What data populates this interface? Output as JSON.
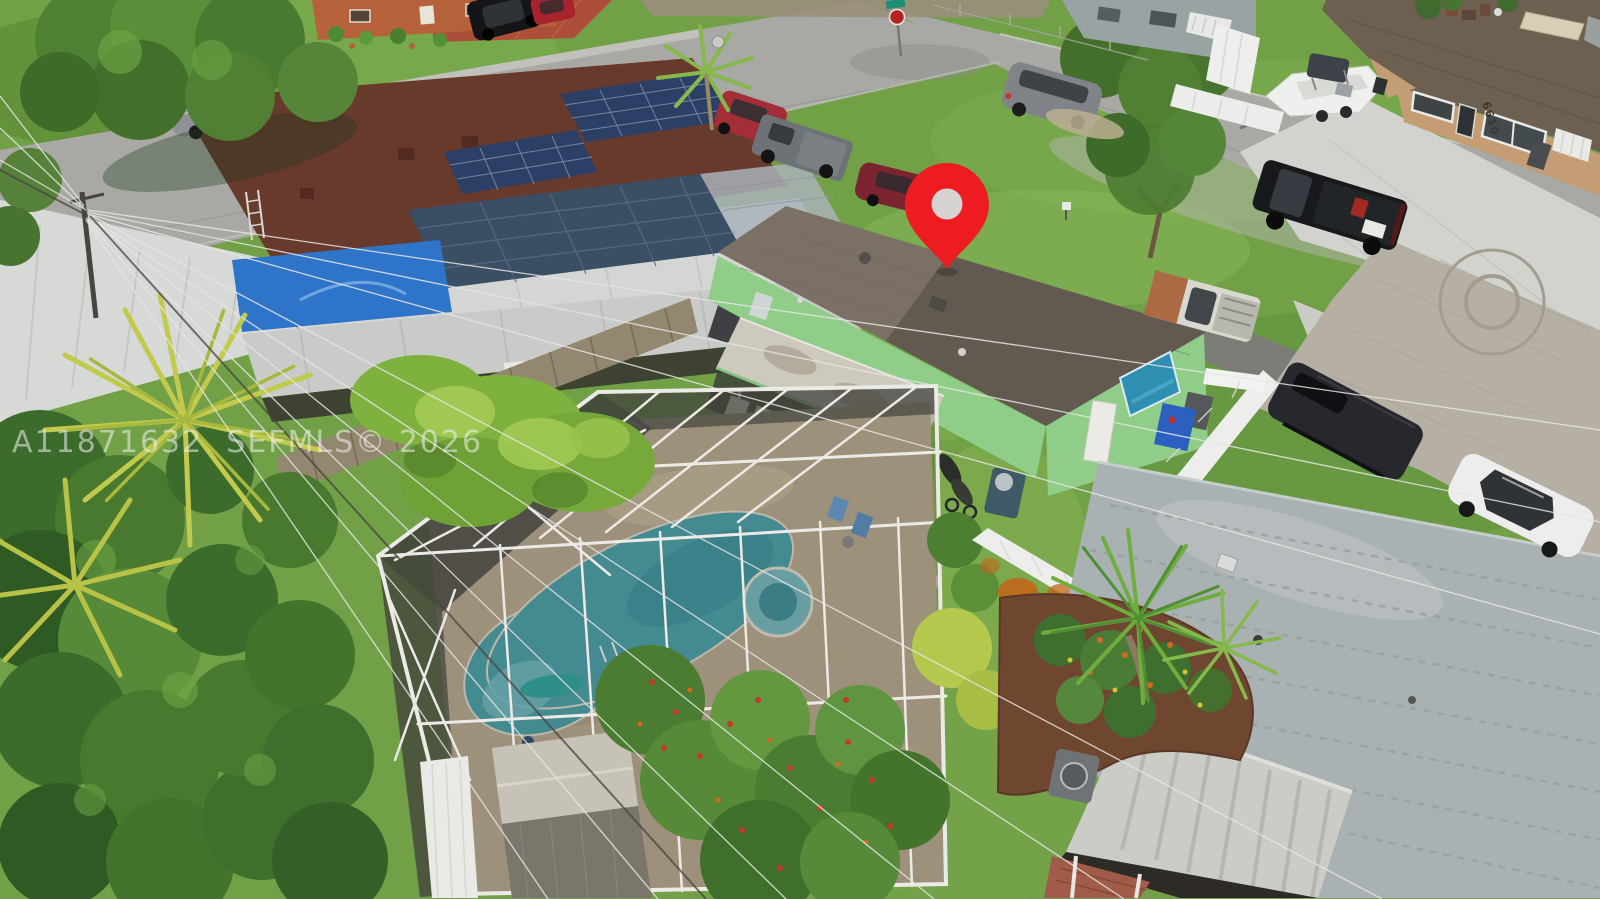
{
  "scene": {
    "type": "aerial-real-estate-photo",
    "description": "Drone aerial view of a residential neighborhood; a red location pin marks a mint-green single-family house with a screened-in pool enclosure, beside a neighbor house with rooftop solar panels and a bright blue pool; curved streets, parked cars, a boat on a trailer, palms and lawns surround the lots.",
    "watermark": "A11871632  SEFMLS© 2026"
  },
  "labels": {
    "neighbor_house_number": "6610"
  },
  "colors": {
    "pin": "#ec1c20",
    "pin_inner": "#d6d4d2",
    "grass": "#71a046",
    "street": "#a8a9a5",
    "subject_walls": "#8fcd89",
    "subject_roof": "#7a7164",
    "pool_water": "#4a9ba5",
    "pool_deck": "#b3a48b",
    "neighbor_pool": "#2e74c8",
    "solar_panel": "#2c4067",
    "solar_roof": "#673a2c",
    "gray_roof": "#aab1b3",
    "tan_house": "#c49d74",
    "pvc_fence": "#ededeb",
    "rust_stain": "#c2661a",
    "watermark": "rgba(242,242,242,0.55)"
  },
  "objects": [
    {
      "name": "red-map-pin",
      "label": "location pin over subject house"
    },
    {
      "name": "subject-house",
      "label": "mint green house, gray shingle roof"
    },
    {
      "name": "pool-enclosure",
      "label": "screened pool cage"
    },
    {
      "name": "swimming-pool",
      "label": "teal pool with round spa"
    },
    {
      "name": "solar-house",
      "label": "neighbor house with rooftop solar panels"
    },
    {
      "name": "neighbor-pool",
      "label": "bright blue backyard pool"
    },
    {
      "name": "street-intersection",
      "label": "street corner with stop sign"
    },
    {
      "name": "boat-on-trailer",
      "label": "white center-console boat"
    },
    {
      "name": "black-pickup-truck",
      "label": "black pickup in driveway"
    },
    {
      "name": "rusty-pickup-truck",
      "label": "white pickup with rusted hood"
    },
    {
      "name": "dark-van",
      "label": "dark cargo van"
    },
    {
      "name": "white-sedan",
      "label": "white sedan on pavers"
    },
    {
      "name": "gray-minivan",
      "label": "gray minivan on grass"
    },
    {
      "name": "gray-sedan",
      "label": "gray sedan at curb"
    },
    {
      "name": "red-suv",
      "label": "red SUV"
    },
    {
      "name": "gray-pickup",
      "label": "gray pickup"
    },
    {
      "name": "maroon-sedan",
      "label": "maroon sedan at curb"
    },
    {
      "name": "black-suv",
      "label": "black SUV in tiled driveway"
    },
    {
      "name": "red-hatchback",
      "label": "red hatchback"
    },
    {
      "name": "paver-driveway",
      "label": "paver driveway with circle motif"
    },
    {
      "name": "power-lines",
      "label": "overhead power lines"
    },
    {
      "name": "palm-trees",
      "label": "palms and tropical foliage"
    },
    {
      "name": "watermark",
      "label": "MLS watermark text"
    }
  ]
}
